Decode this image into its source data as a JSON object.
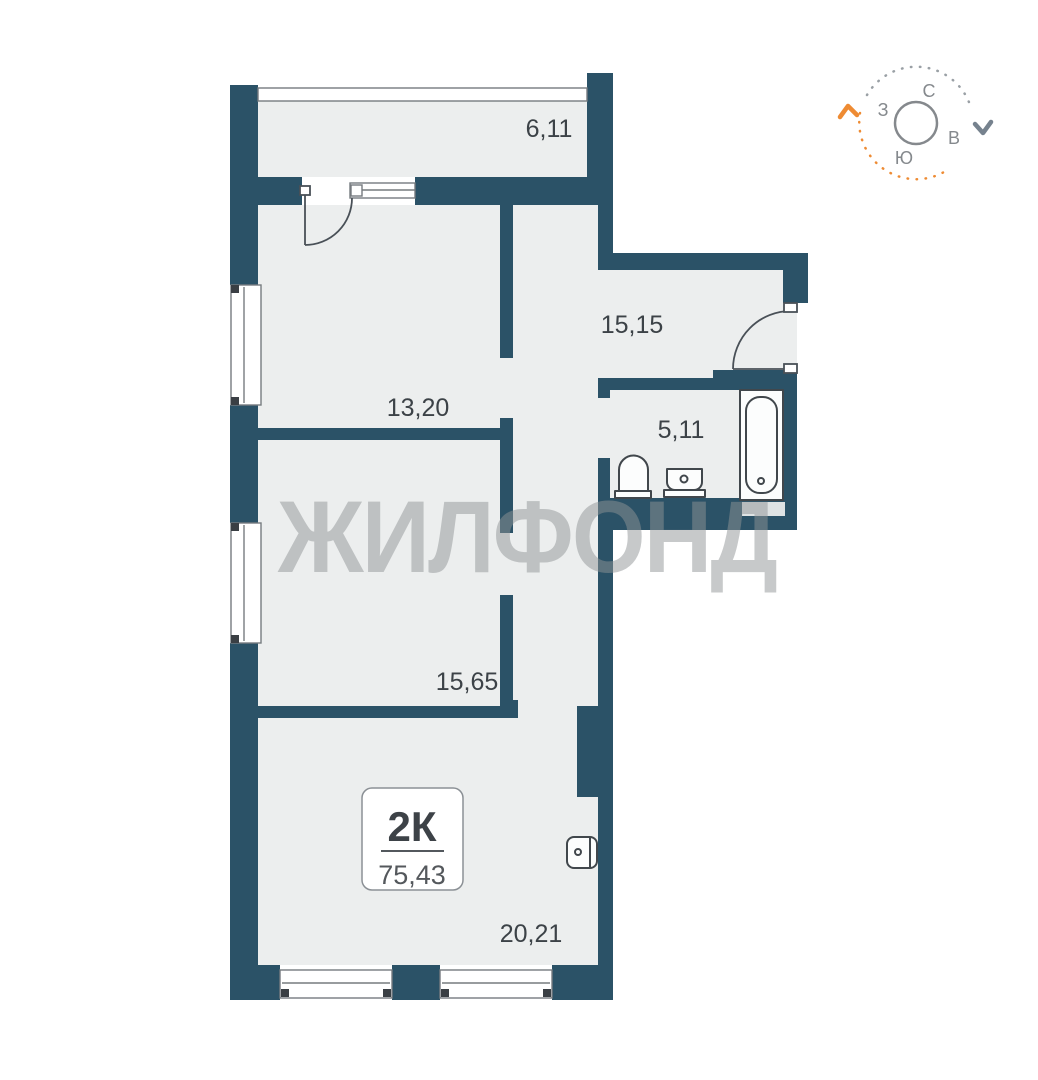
{
  "plan": {
    "watermark": "ЖИЛФОНД",
    "unit_badge": {
      "rooms_label": "2К",
      "total_area": "75,43"
    },
    "rooms": [
      {
        "id": "balcony",
        "area": "6,11"
      },
      {
        "id": "hallway",
        "area": "15,15"
      },
      {
        "id": "room-1",
        "area": "13,20"
      },
      {
        "id": "bathroom",
        "area": "5,11"
      },
      {
        "id": "room-2",
        "area": "15,65"
      },
      {
        "id": "living-kitchen",
        "area": "20,21"
      }
    ],
    "colors": {
      "wall": "#2b5267",
      "floor": "#eceeee",
      "accent_orange": "#ee8b33",
      "label_text": "#3c4247",
      "watermark_gray": "#8f9496"
    }
  },
  "compass": {
    "north": "С",
    "east": "В",
    "south": "Ю",
    "west": "З"
  }
}
